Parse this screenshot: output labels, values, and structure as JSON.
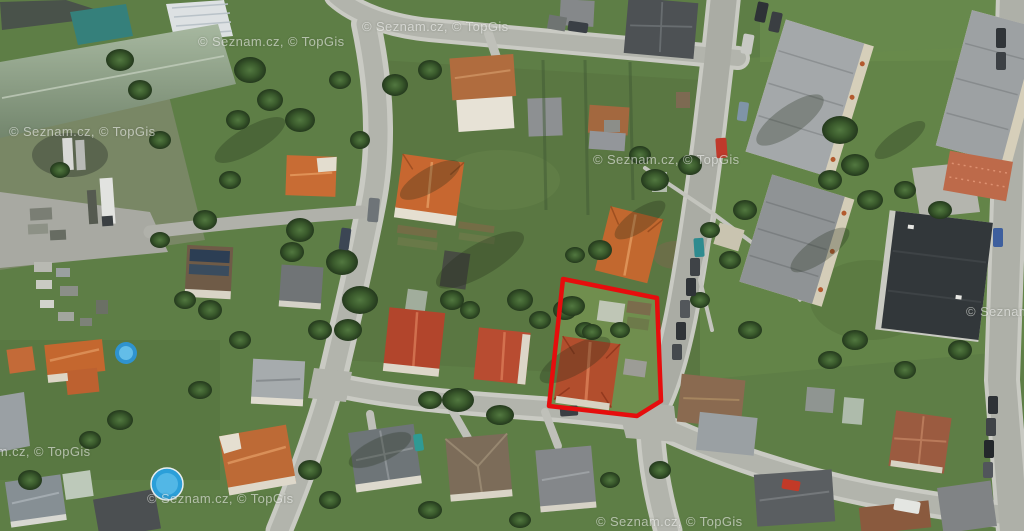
{
  "image": {
    "type": "aerial-satellite-photo",
    "description": "Aerial orthophoto of a residential neighborhood with streets, family houses, gardens, apartment blocks and one land parcel outlined in red",
    "width": 1024,
    "height": 531
  },
  "watermarks": [
    {
      "text": "© Seznam.cz, © TopGis",
      "x": 9,
      "y": 124
    },
    {
      "text": "© Seznam.cz, © TopGis",
      "x": 198,
      "y": 34
    },
    {
      "text": "© Seznam.cz, © TopGis",
      "x": 362,
      "y": 19
    },
    {
      "text": "© Seznam.cz, © TopGis",
      "x": 593,
      "y": 152
    },
    {
      "text": "© Seznam.cz, © TopGis",
      "x": 966,
      "y": 304
    },
    {
      "text": "© Seznam.cz, © TopGis",
      "x": -56,
      "y": 444
    },
    {
      "text": "© Seznam.cz, © TopGis",
      "x": 147,
      "y": 491
    },
    {
      "text": "© Seznam.cz, © TopGis",
      "x": 596,
      "y": 514
    }
  ],
  "highlight": {
    "name": "selected-parcel-outline",
    "polygon_points": "563,279 657,298 661,401 637,416 549,406",
    "stroke_color": "#e60d0d",
    "stroke_width": 4.5
  },
  "colors": {
    "grass": "#5e7e46",
    "road": "#b2b4ac",
    "sidewalk": "#c9cac3",
    "highlight_red": "#e60d0d",
    "roof_orange": "#c4672f",
    "roof_red": "#b2452c",
    "roof_gray": "#8d9092",
    "roof_dark": "#32373a",
    "industrial_green_roof": "#8ba183",
    "teal_roof": "#35807b",
    "pool_blue": "#2b9fd9",
    "tree_green": "#3a5a2c"
  }
}
